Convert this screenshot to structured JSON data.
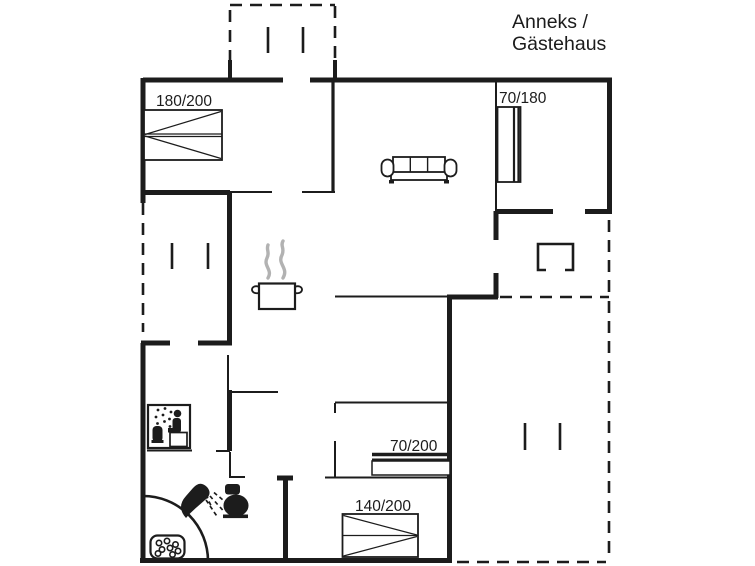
{
  "title": {
    "line1": "Anneks /",
    "line2": "Gästehaus"
  },
  "beds": {
    "master": "180/200",
    "guest_single": "70/180",
    "single": "70/200",
    "double": "140/200"
  },
  "icons": {
    "double-bed-icon": "double bed 180/200 in top-left bedroom",
    "single-bed-70-180-icon": "single bed 70/180 in top-right room",
    "single-bed-70-200-icon": "single bed 70/200 in middle room",
    "double-bed-140-200-icon": "double bed 140/200 in bottom bedroom",
    "sofa-icon": "three-seat sofa in living room",
    "cooking-pot-icon": "steaming pot marking kitchen",
    "sauna-icon": "sauna with person, bench and stove",
    "shower-icon": "shower head with spray",
    "toilet-icon": "toilet",
    "whirlpool-icon": "corner whirlpool bath with bubbles",
    "terrace-table-icon": "furniture symbol on covered terrace",
    "terrace-door-ticks": "door opening marks on terraces"
  },
  "colors": {
    "line": "#1c1c1c",
    "background": "#ffffff",
    "steam_gray": "#b2b2b2"
  }
}
